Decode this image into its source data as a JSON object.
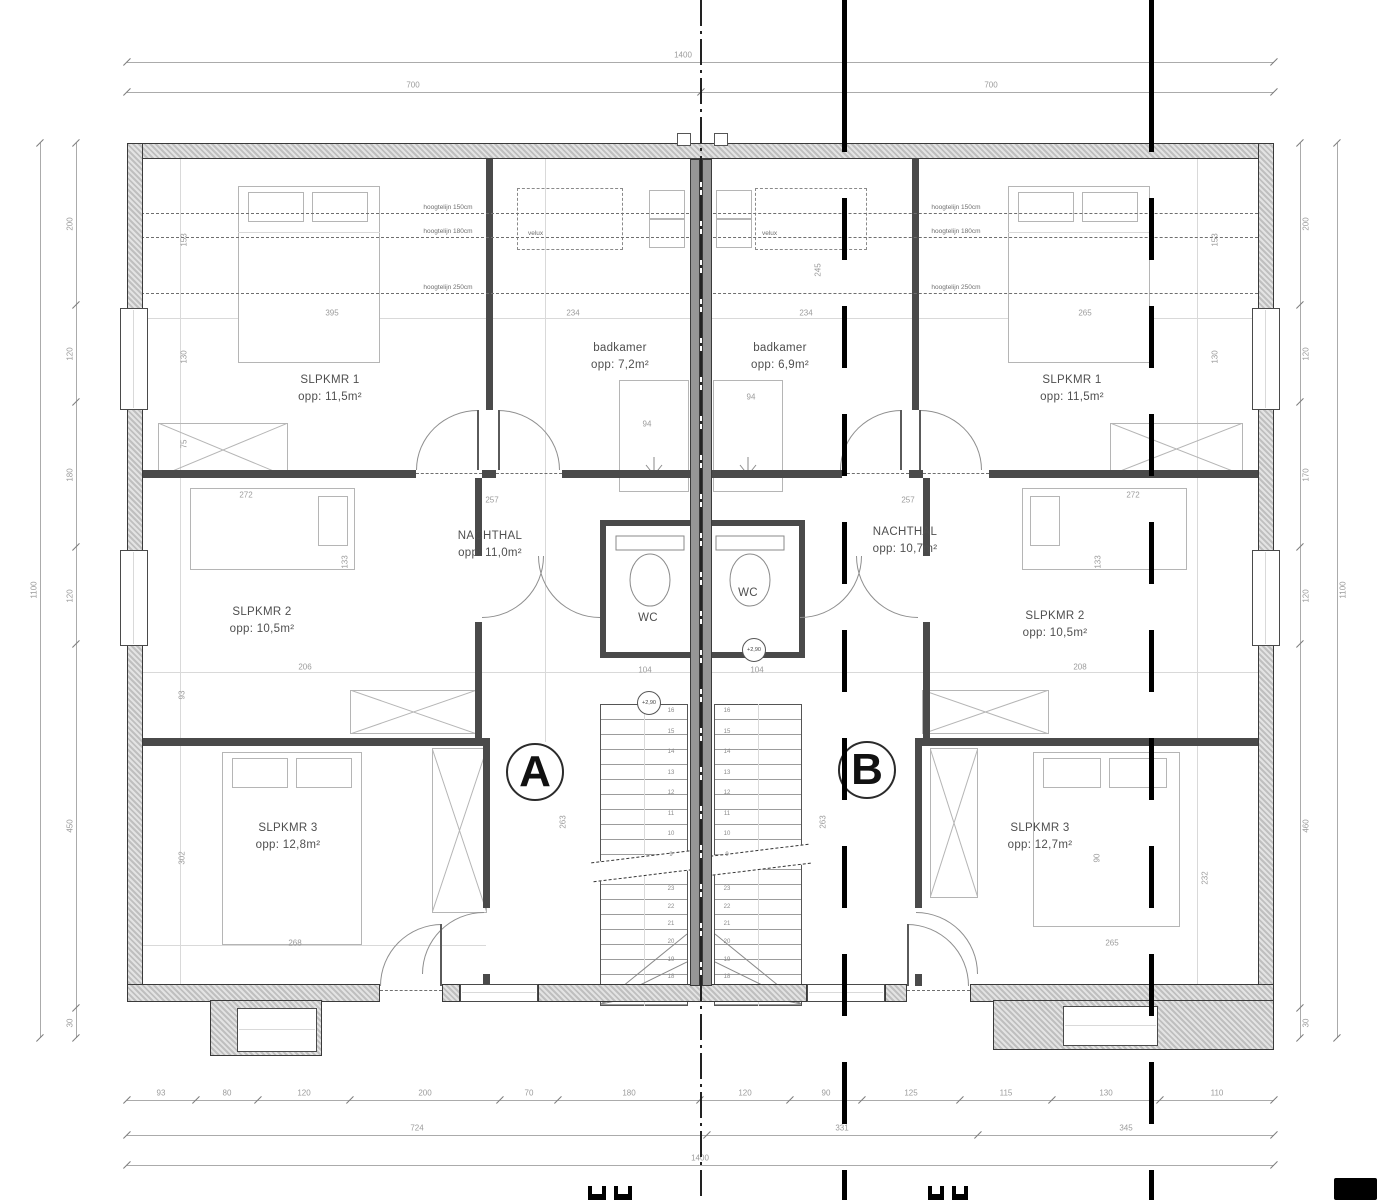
{
  "colors": {
    "wall_line": "#3a3a3a",
    "wall_hatch": "#c8c8c8",
    "interior_wall": "#4a4a4a",
    "furniture_line": "#b5b5b5",
    "dim_text": "#9b9b9b",
    "section_line": "#000000"
  },
  "plan": {
    "units": [
      {
        "label": "A",
        "rooms": [
          {
            "name": "SLPKMR 1",
            "area": "opp: 11,5m²"
          },
          {
            "name": "badkamer",
            "area": "opp: 7,2m²"
          },
          {
            "name": "NACHTHAL",
            "area": "opp: 11,0m²"
          },
          {
            "name": "WC",
            "area": ""
          },
          {
            "name": "SLPKMR 2",
            "area": "opp: 10,5m²"
          },
          {
            "name": "SLPKMR 3",
            "area": "opp: 12,8m²"
          }
        ]
      },
      {
        "label": "B",
        "rooms": [
          {
            "name": "badkamer",
            "area": "opp: 6,9m²"
          },
          {
            "name": "SLPKMR 1",
            "area": "opp: 11,5m²"
          },
          {
            "name": "NACHTHAL",
            "area": "opp: 10,7m²"
          },
          {
            "name": "WC",
            "area": ""
          },
          {
            "name": "SLPKMR 2",
            "area": "opp: 10,5m²"
          },
          {
            "name": "SLPKMR 3",
            "area": "opp: 12,7m²"
          }
        ]
      }
    ],
    "height_labels": [
      "hoogtelijn 150cm",
      "hoogtelijn 180cm",
      "hoogtelijn 250cm"
    ],
    "skylight_label": "velux",
    "level_marker": "+2,90",
    "stair_numbers": {
      "upper": [
        "16",
        "15",
        "14",
        "13",
        "12",
        "11",
        "10",
        "9"
      ],
      "lower": [
        "23",
        "22",
        "21",
        "20",
        "19",
        "18",
        "17"
      ]
    },
    "dims": {
      "top_total": "1400",
      "top_halves": [
        "700",
        "700"
      ],
      "bottom_segments": [
        "93",
        "80",
        "120",
        "200",
        "70",
        "180",
        "120",
        "90",
        "125",
        "115",
        "130",
        "110"
      ],
      "bottom_row2": [
        "724",
        "331",
        "345"
      ],
      "bottom_total": "1400",
      "side_total_left": "1100",
      "side_total_right": "1100",
      "left_chain": [
        "200",
        "120",
        "180",
        "120",
        "450",
        "30"
      ],
      "right_chain": [
        "200",
        "120",
        "170",
        "120",
        "460",
        "30"
      ],
      "interior": {
        "a_bed1_w": "395",
        "a_bath_w": "234",
        "b_bath_w": "234",
        "b_bed1_w": "265",
        "a_hall_w": "257",
        "b_hall_w": "257",
        "a_shaft": "94",
        "b_shaft": "94",
        "a_stair_w": "104",
        "b_stair_w": "104",
        "a_mid": "206",
        "b_mid": "208",
        "a_bed2_l": "272",
        "b_bed2_l": "272",
        "a_bed2_w": "133",
        "b_bed2_w": "133",
        "a_stair_l": "263",
        "b_stair_l": "263",
        "a_bed3_w": "268",
        "b_bed3_w": "265",
        "a_room3_l": "302",
        "a_room2_l": "93",
        "b_hall_l": "90",
        "b_room3_l": "232",
        "b_bath_l": "245",
        "a_side1": "153",
        "a_side2": "130",
        "a_side3": "75",
        "b_side1": "153",
        "b_side2": "130"
      }
    }
  }
}
